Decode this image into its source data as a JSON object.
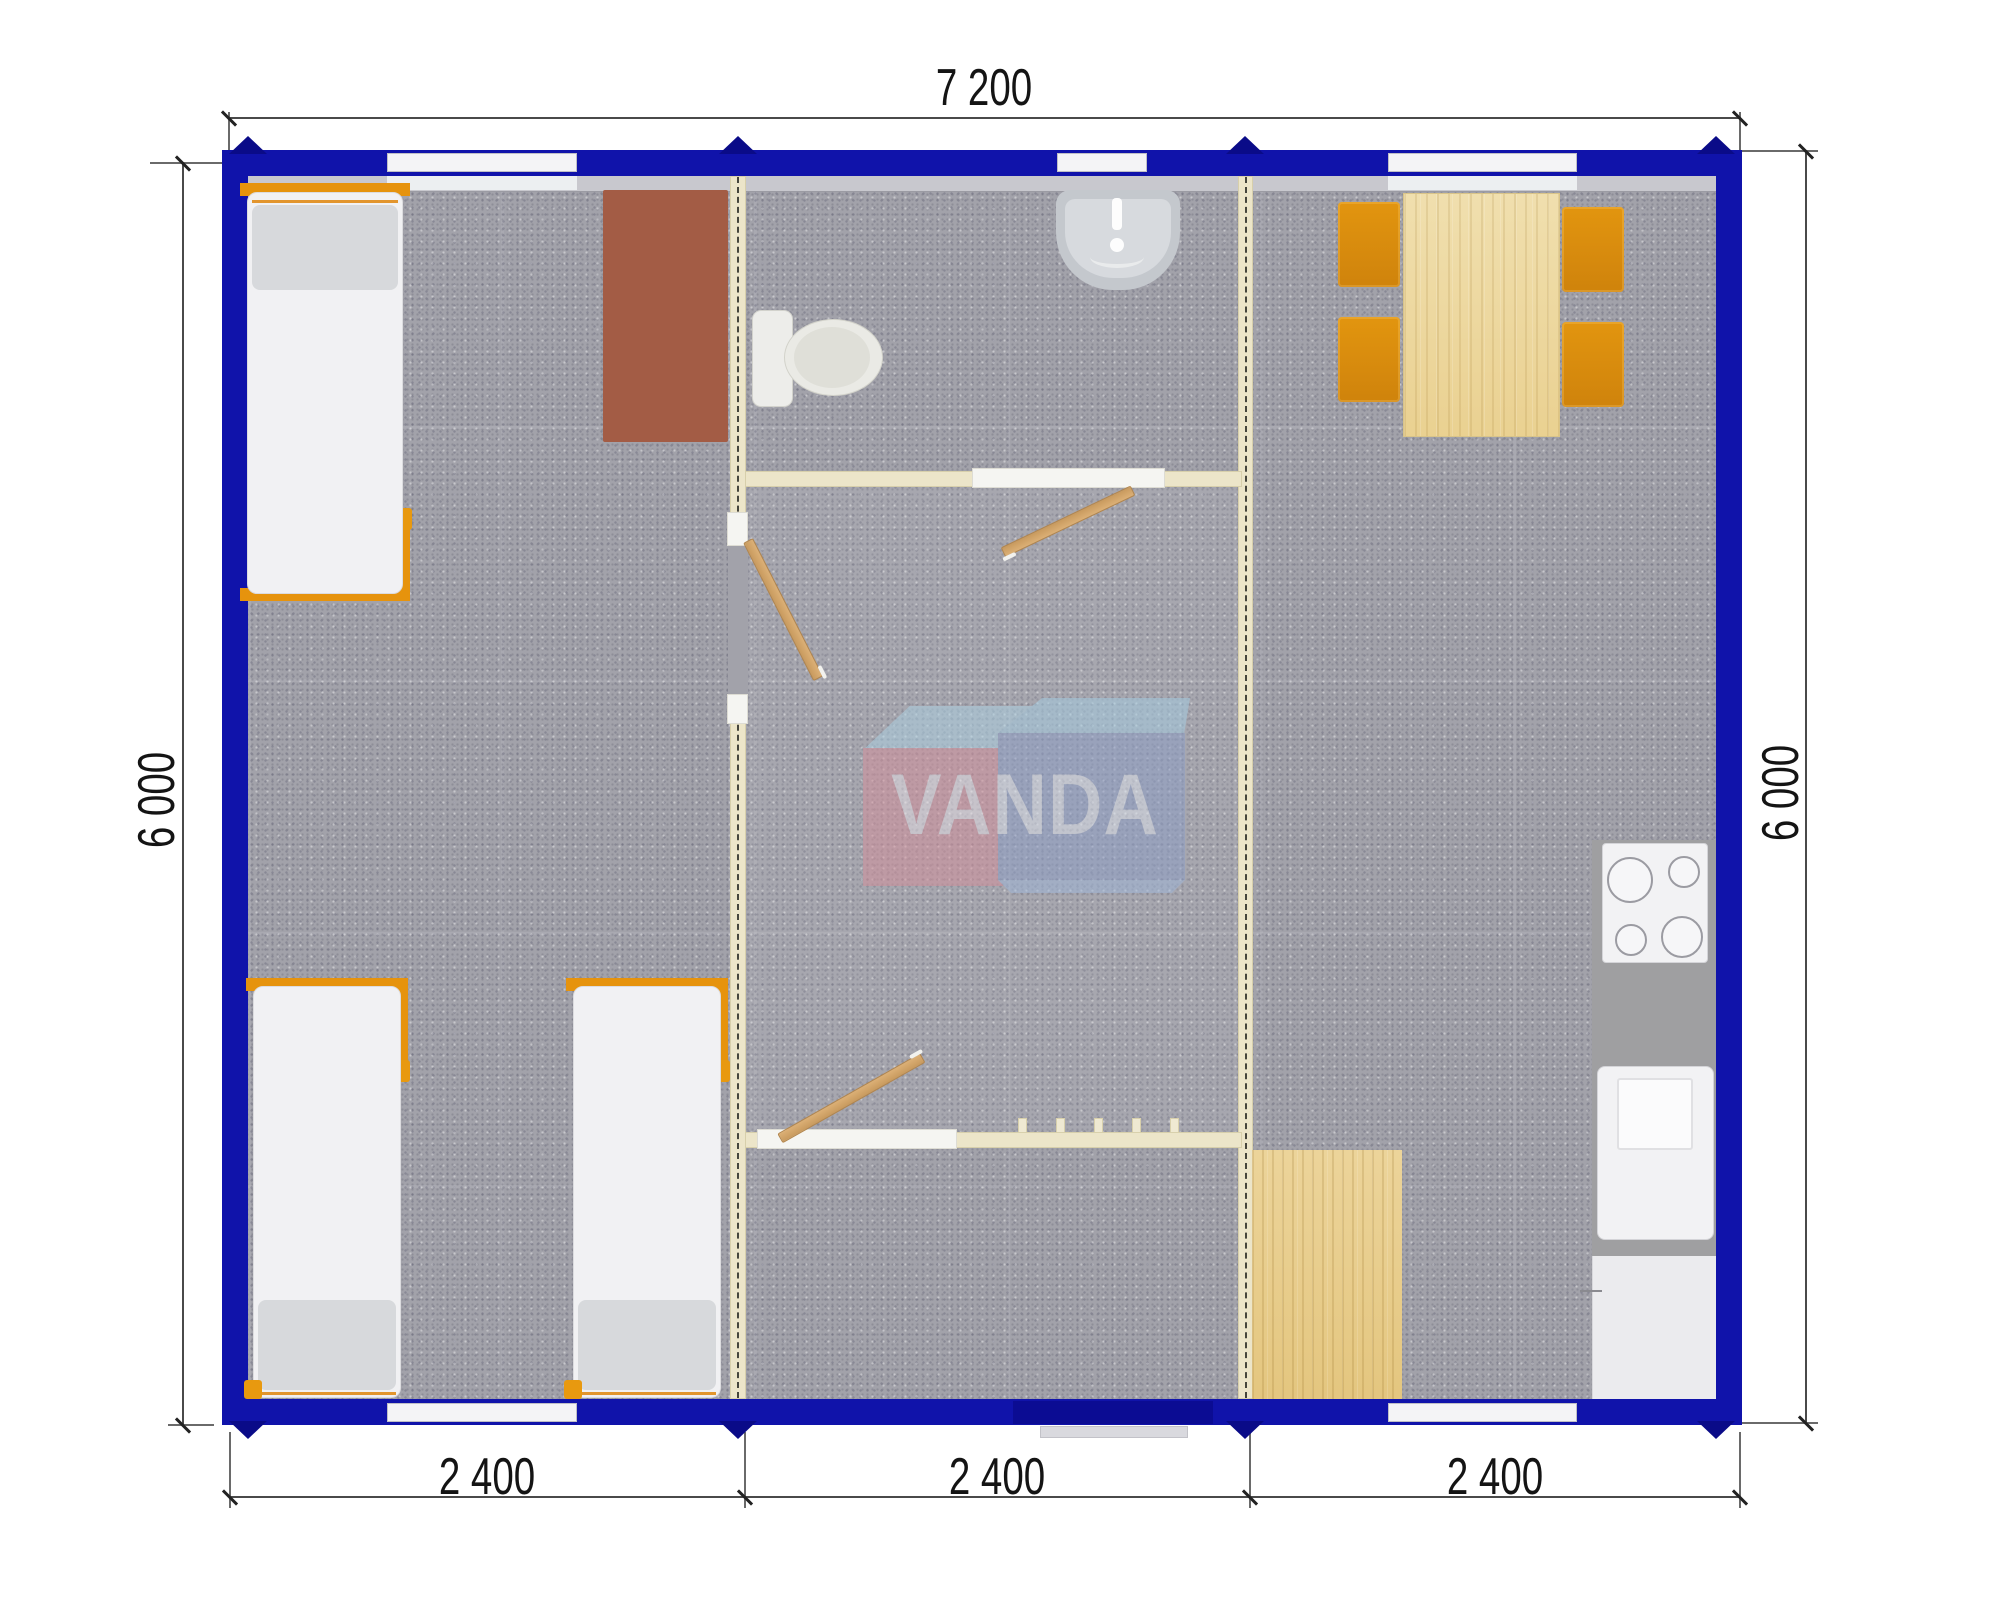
{
  "title": "VANDA modular building floor plan",
  "watermark": {
    "brand": "VANDA"
  },
  "dimensions": {
    "top_width": "7 200",
    "left_height": "6 000",
    "right_height": "6 000",
    "bottom_modules": [
      "2 400",
      "2 400",
      "2 400"
    ]
  },
  "colors": {
    "wall_blue": "#1013aa",
    "corner_post_blue": "#0a0b88",
    "partition_cream": "#ece5c9",
    "floor_gray": "#a2a2aa",
    "furniture_orange": "#e6930d",
    "wood_light": "#ead191",
    "desk_brown": "#a35c45",
    "watermark_pink": "#d48f9a",
    "watermark_blue": "#8d9ec6"
  },
  "furniture_icons": [
    "single-bed",
    "single-bed",
    "single-bed",
    "desk",
    "toilet",
    "washbasin",
    "dining-table",
    "chair",
    "chair",
    "chair",
    "chair",
    "cooktop",
    "kitchen-sink",
    "refrigerator",
    "wood-floor-mat",
    "interior-door",
    "interior-door",
    "interior-door",
    "entrance-door",
    "window",
    "window",
    "window",
    "window",
    "window",
    "coat-hooks"
  ]
}
